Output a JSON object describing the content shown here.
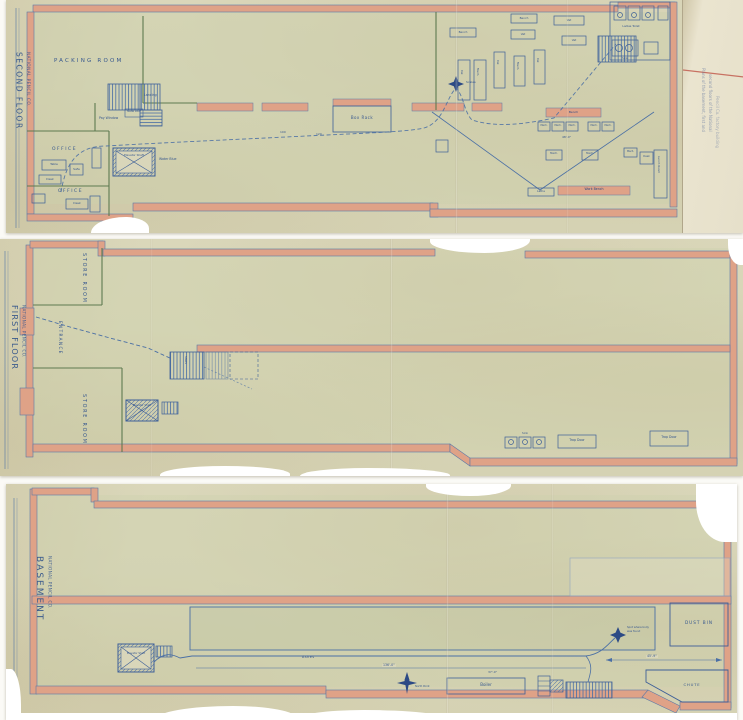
{
  "second_floor": {
    "title": "SECOND FLOOR",
    "subtitle": "NATIONAL PENCIL CO.",
    "labels": {
      "packing_room": "PACKING ROOM",
      "office": "OFFICE",
      "table": "Table",
      "desk": "Desk",
      "safe": "Safe",
      "elevator_shaft": "Elevator Shaft",
      "water_blue": "Water Blue",
      "landing": "Landing",
      "metal_door": "Metal Door",
      "pay_window": "Pay Window",
      "box_rack": "Box Rack",
      "scales": "Scales",
      "bench": "Bench",
      "vat": "Vat",
      "mach": "Mach.",
      "lathe": "Lathe",
      "work_bench": "Work Bench",
      "lunch_room": "Lunch Room",
      "ladies_toilet": "Ladies Toilet",
      "sink": "Sink",
      "dim_48": "48'-0\"",
      "dim_100": "100",
      "dim_120": "120"
    },
    "flap_note_line1": "Plans of the basement, first and",
    "flap_note_line2": "second floors of the National",
    "flap_note_line3": "Pencil Co. factory building"
  },
  "first_floor": {
    "title": "FIRST FLOOR",
    "subtitle": "NATIONAL PENCIL CO.",
    "labels": {
      "store_room": "STORE ROOM",
      "entrance": "ENTRANCE",
      "elevator_shaft": "Elevator Shaft",
      "stairs": "Stairs",
      "trap_door": "Trap Door",
      "sink": "Sink"
    }
  },
  "basement": {
    "title": "BASEMENT",
    "subtitle": "NATIONAL PENCIL CO.",
    "labels": {
      "elevator_shaft": "Elevator Shaft",
      "ashes": "Ashes",
      "boiler": "Boiler",
      "dust_bin": "DUST BIN",
      "chute": "CHUTE",
      "body_spot_line1": "Spot where body",
      "body_spot_line2": "was found",
      "north_point": "North Point",
      "dim_136": "136'-0\"",
      "dim_37": "37'-0\"",
      "dim_45": "45'-9\""
    }
  },
  "colors": {
    "paper": "#d9d6ba",
    "wall_fill": "#dfa287",
    "ink_blue": "#3d5f98",
    "ink_green": "#5e7a50",
    "flap_paper": "#e9e3cd",
    "red_line": "#c05548"
  }
}
